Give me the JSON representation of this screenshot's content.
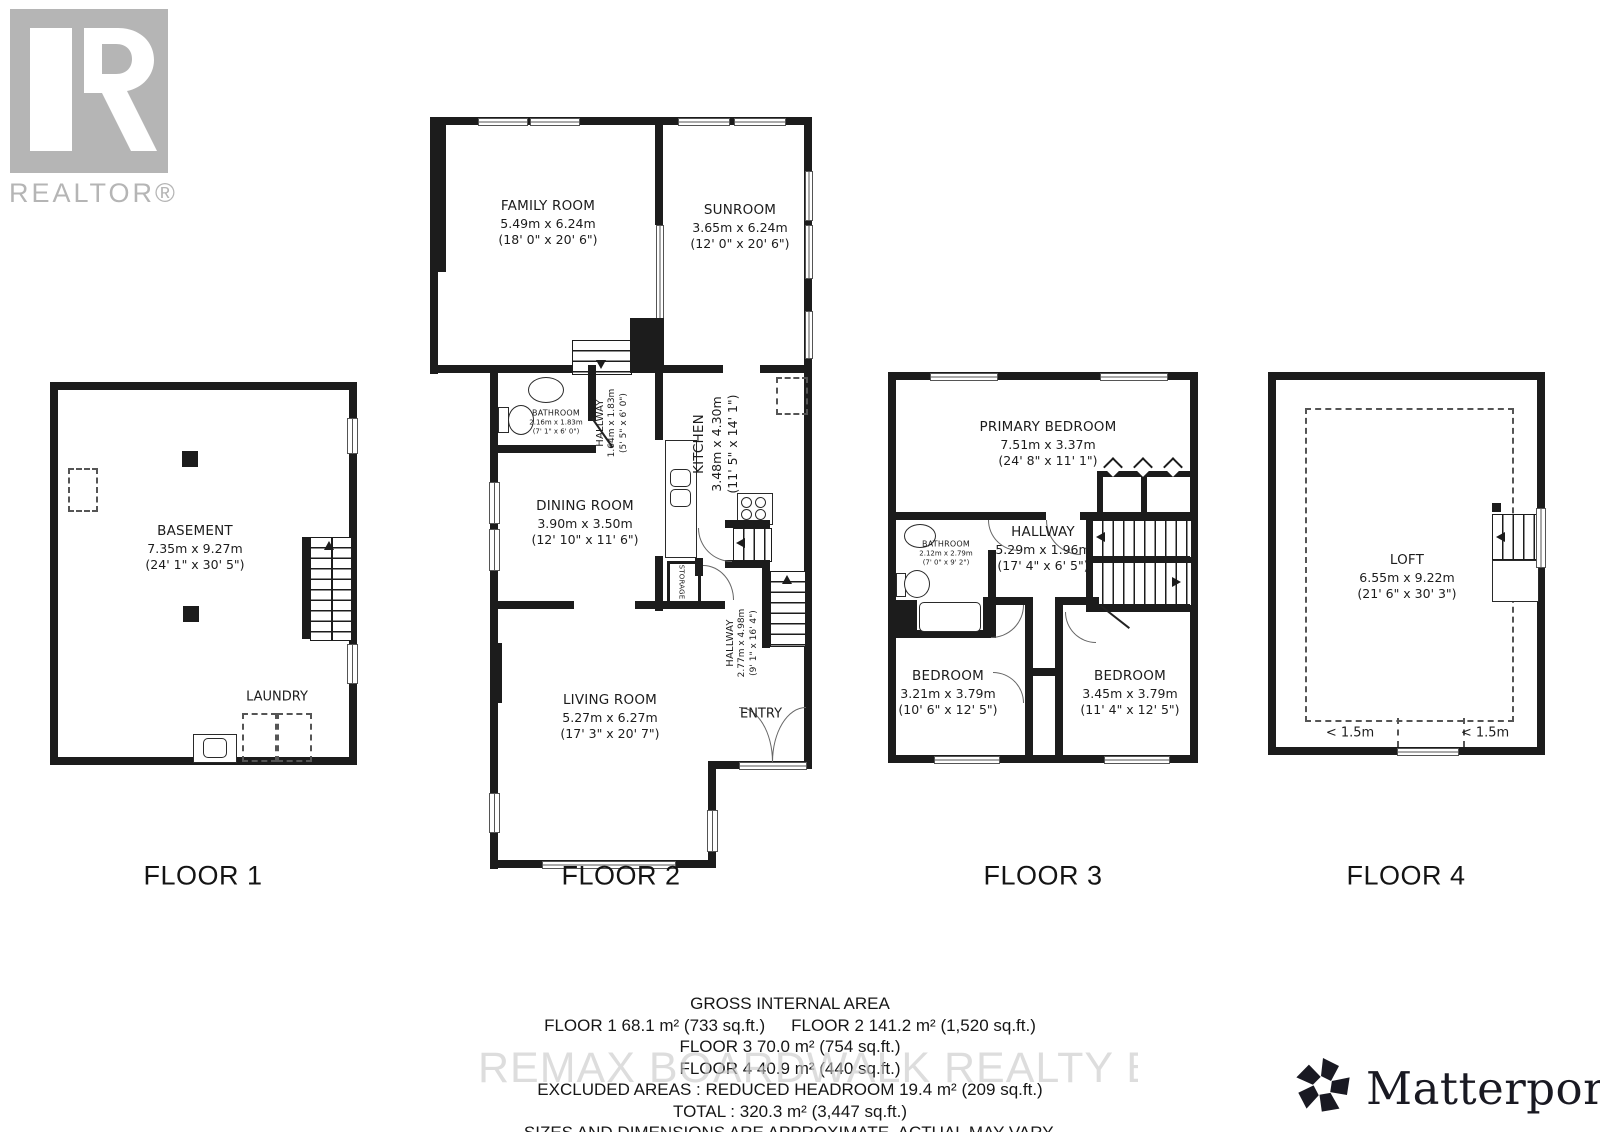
{
  "branding": {
    "realtor_wordmark": "REALTOR®",
    "matterport_wordmark": "Matterport®",
    "watermark": "REMAX BOARDWALK REALTY Brokerage",
    "colors": {
      "wall": "#1c1c1c",
      "realtor_gray": "#b5b5b5",
      "matterport_dark": "#191922",
      "watermark_gray": "#c9c9c9"
    }
  },
  "floor1": {
    "label": "FLOOR 1",
    "basement": {
      "name": "BASEMENT",
      "metric": "7.35m x 9.27m",
      "imperial": "(24' 1\" x 30' 5\")"
    },
    "laundry": {
      "name": "LAUNDRY"
    }
  },
  "floor2": {
    "label": "FLOOR 2",
    "family_room": {
      "name": "FAMILY ROOM",
      "metric": "5.49m x 6.24m",
      "imperial": "(18' 0\" x 20' 6\")"
    },
    "sunroom": {
      "name": "SUNROOM",
      "metric": "3.65m x 6.24m",
      "imperial": "(12' 0\" x 20' 6\")"
    },
    "bathroom": {
      "name": "BATHROOM",
      "metric": "2.16m x 1.83m",
      "imperial": "(7' 1\" x 6' 0\")"
    },
    "hallway": {
      "name": "HALLWAY",
      "metric": "1.64m x 1.83m",
      "imperial": "(5' 5\" x 6' 0\")"
    },
    "kitchen": {
      "name": "KITCHEN",
      "metric": "3.48m x 4.30m",
      "imperial": "(11' 5\" x 14' 1\")"
    },
    "dining_room": {
      "name": "DINING ROOM",
      "metric": "3.90m x 3.50m",
      "imperial": "(12' 10\" x 11' 6\")"
    },
    "storage": {
      "name": "STORAGE"
    },
    "hallway2": {
      "name": "HALLWAY",
      "metric": "2.77m x 4.98m",
      "imperial": "(9' 1\" x 16' 4\")"
    },
    "living_room": {
      "name": "LIVING ROOM",
      "metric": "5.27m x 6.27m",
      "imperial": "(17' 3\" x 20' 7\")"
    },
    "entry": {
      "name": "ENTRY"
    }
  },
  "floor3": {
    "label": "FLOOR 3",
    "primary_bedroom": {
      "name": "PRIMARY BEDROOM",
      "metric": "7.51m x 3.37m",
      "imperial": "(24' 8\" x 11' 1\")"
    },
    "hallway": {
      "name": "HALLWAY",
      "metric": "5.29m x 1.96m",
      "imperial": "(17' 4\" x 6' 5\")"
    },
    "bathroom": {
      "name": "BATHROOM",
      "metric": "2.12m x 2.79m",
      "imperial": "(7' 0\" x 9' 2\")"
    },
    "bedroom_left": {
      "name": "BEDROOM",
      "metric": "3.21m x 3.79m",
      "imperial": "(10' 6\" x 12' 5\")"
    },
    "bedroom_right": {
      "name": "BEDROOM",
      "metric": "3.45m x 3.79m",
      "imperial": "(11' 4\" x 12' 5\")"
    }
  },
  "floor4": {
    "label": "FLOOR 4",
    "loft": {
      "name": "LOFT",
      "metric": "6.55m x 9.22m",
      "imperial": "(21' 6\" x 30' 3\")"
    },
    "headroom_left": "< 1.5m",
    "headroom_right": "< 1.5m"
  },
  "summary": {
    "title": "GROSS INTERNAL AREA",
    "floor1": "FLOOR 1 68.1 m² (733 sq.ft.)",
    "floor2": "FLOOR 2 141.2 m² (1,520 sq.ft.)",
    "floor3": "FLOOR 3 70.0 m² (754 sq.ft.)",
    "floor4": "FLOOR 4 40.9 m² (440 sq.ft.)",
    "excluded": "EXCLUDED AREAS :  REDUCED HEADROOM 19.4 m² (209 sq.ft.)",
    "total": "TOTAL :  320.3 m² (3,447 sq.ft.)",
    "disclaimer": "SIZES AND DIMENSIONS ARE APPROXIMATE, ACTUAL MAY VARY."
  }
}
